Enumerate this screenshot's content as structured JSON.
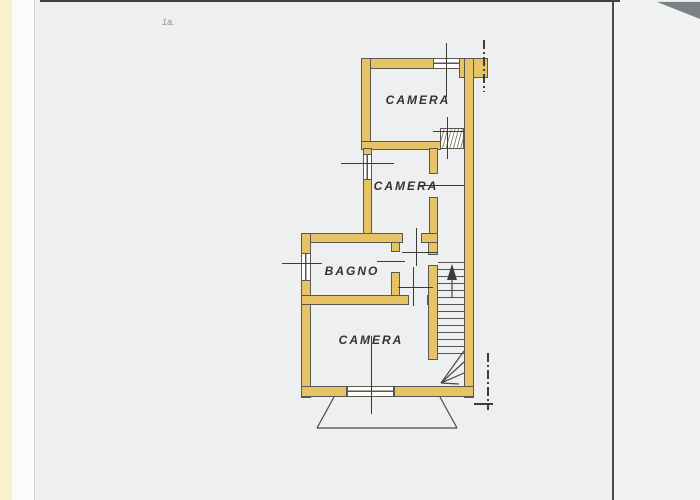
{
  "document": {
    "corner_note": "1a.",
    "rooms": [
      {
        "id": "camera-1",
        "label": "CAMERA"
      },
      {
        "id": "camera-2",
        "label": "CAMERA"
      },
      {
        "id": "bagno",
        "label": "BAGNO"
      },
      {
        "id": "camera-3",
        "label": "CAMERA"
      }
    ],
    "stair": {
      "symbol": "up-arrow"
    },
    "colors": {
      "wall_fill": "#e6c466",
      "line": "#5a574e",
      "paper": "#edeff0"
    }
  }
}
